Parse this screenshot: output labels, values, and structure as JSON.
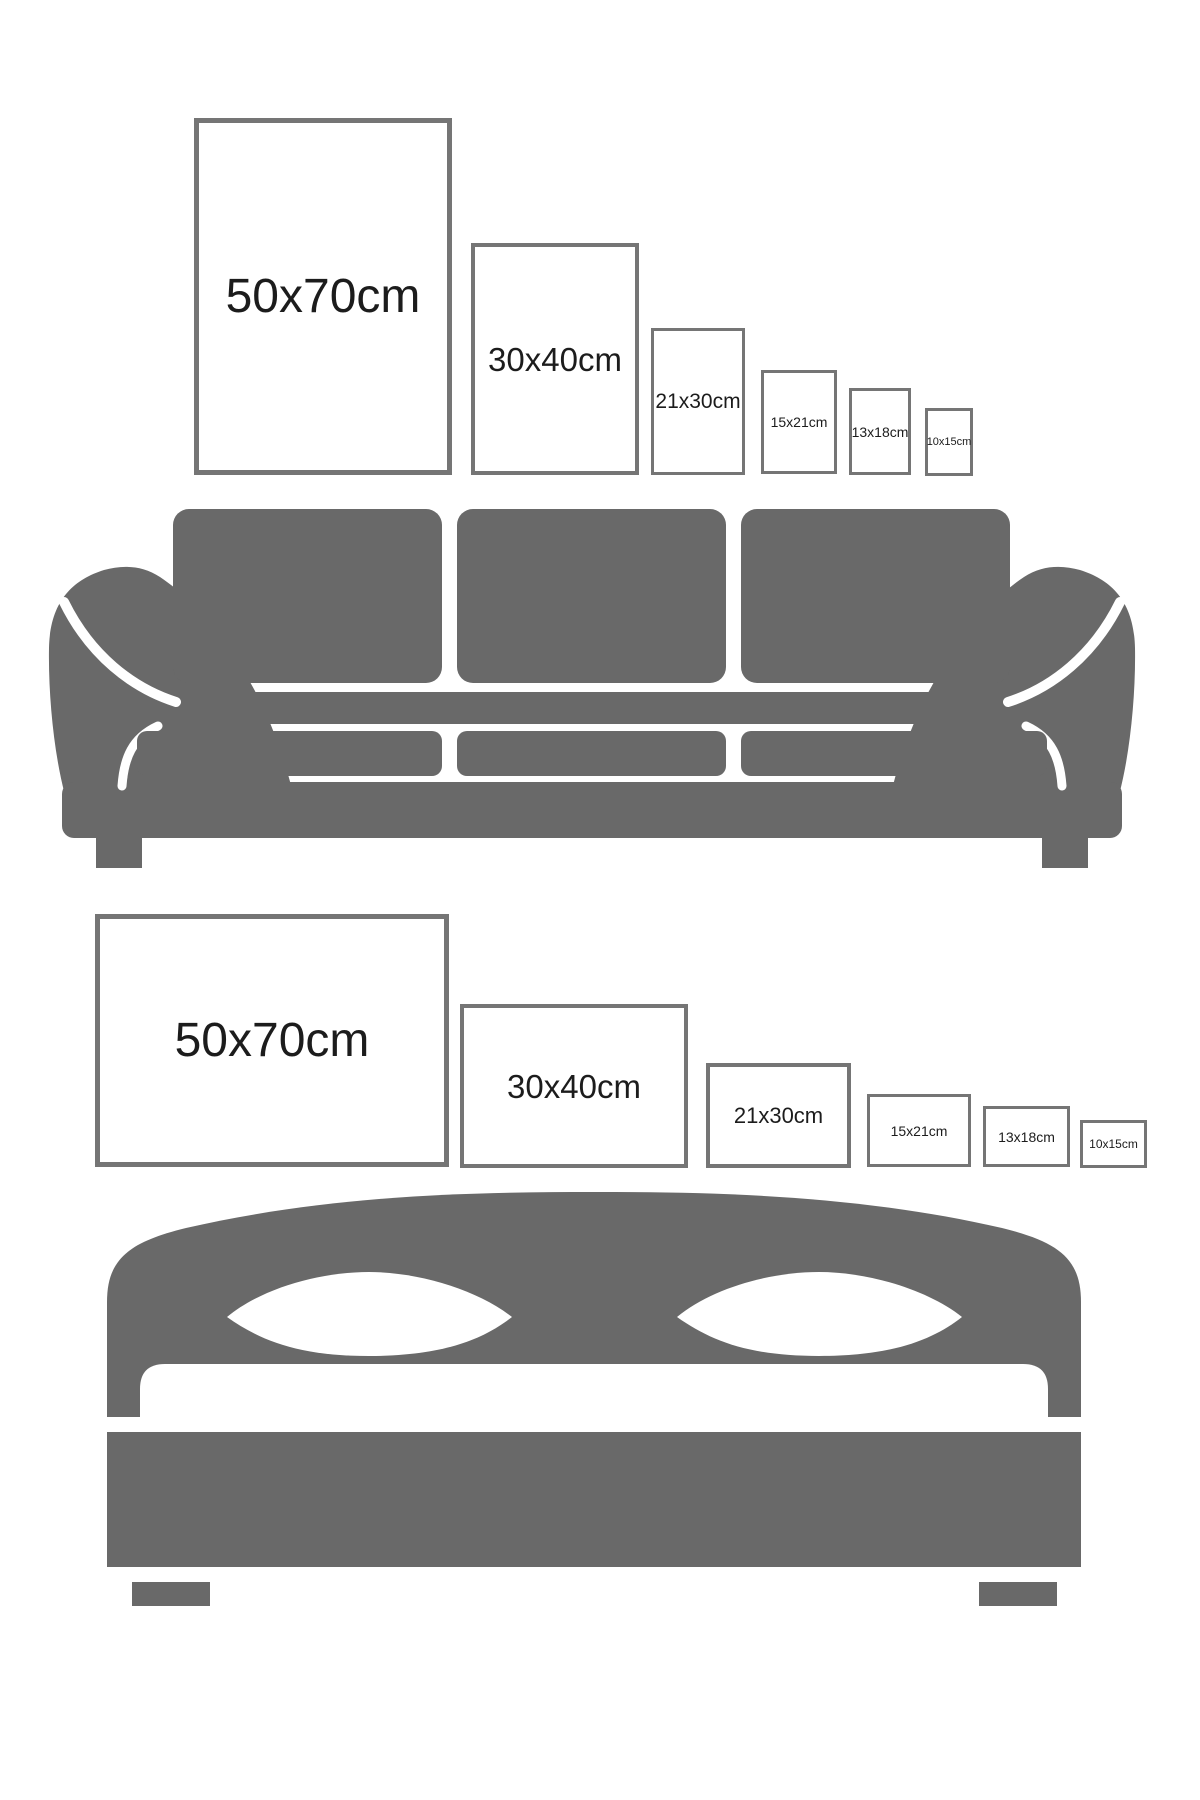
{
  "page": {
    "description": "Poster size comparison guide showing frame sizes above a sofa and a bed"
  },
  "colors": {
    "background": "#ffffff",
    "furniture": "#696969",
    "frameborder": "#757575",
    "labeltext": "#1c1c1c"
  },
  "top_section": {
    "furniture": "sofa",
    "frames": [
      {
        "label": "50x70cm",
        "orientation": "portrait"
      },
      {
        "label": "30x40cm",
        "orientation": "portrait"
      },
      {
        "label": "21x30cm",
        "orientation": "portrait"
      },
      {
        "label": "15x21cm",
        "orientation": "portrait"
      },
      {
        "label": "13x18cm",
        "orientation": "portrait"
      },
      {
        "label": "10x15cm",
        "orientation": "portrait"
      }
    ]
  },
  "bottom_section": {
    "furniture": "bed",
    "frames": [
      {
        "label": "50x70cm",
        "orientation": "landscape"
      },
      {
        "label": "30x40cm",
        "orientation": "landscape"
      },
      {
        "label": "21x30cm",
        "orientation": "landscape"
      },
      {
        "label": "15x21cm",
        "orientation": "landscape"
      },
      {
        "label": "13x18cm",
        "orientation": "landscape"
      },
      {
        "label": "10x15cm",
        "orientation": "landscape"
      }
    ]
  }
}
